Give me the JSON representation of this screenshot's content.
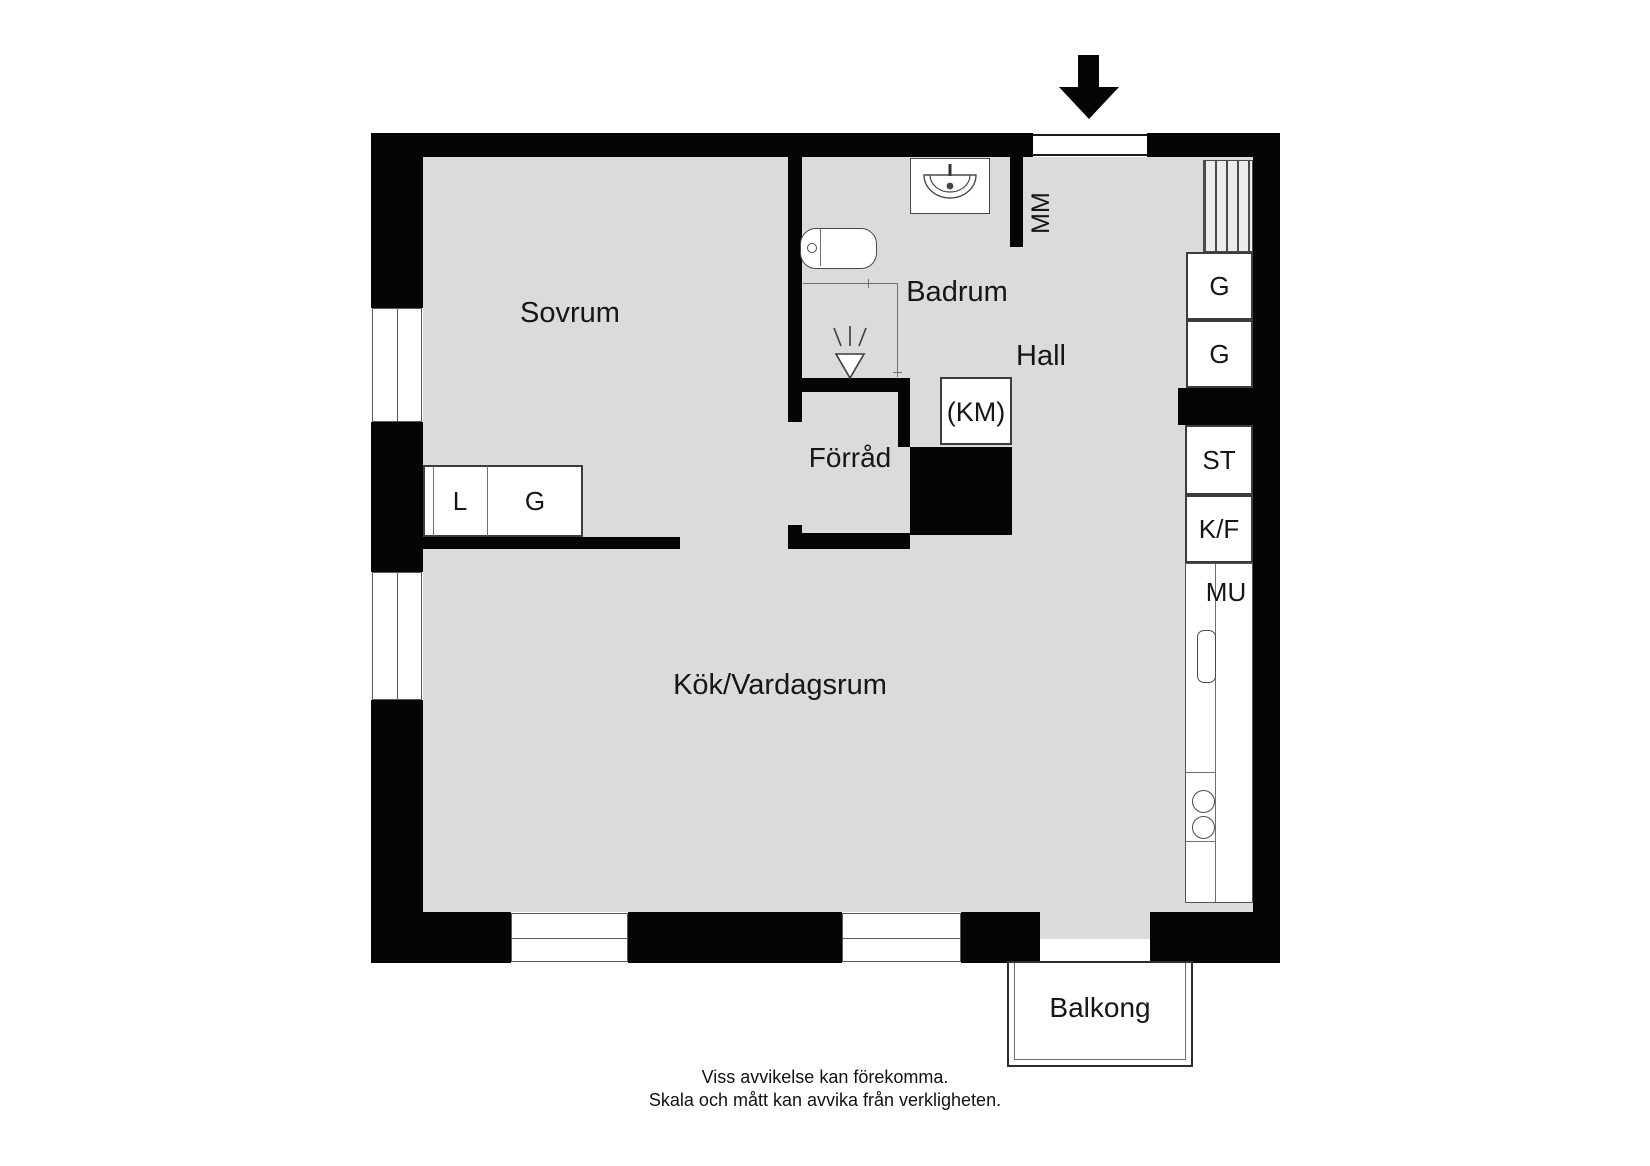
{
  "floorplan": {
    "title": "apartment-floor-plan",
    "rooms": {
      "sovrum": {
        "label": "Sovrum"
      },
      "badrum": {
        "label": "Badrum"
      },
      "hall": {
        "label": "Hall"
      },
      "forrad": {
        "label": "Förråd"
      },
      "kok_vardagsrum": {
        "label": "Kök/Vardagsrum"
      },
      "balkong": {
        "label": "Balkong"
      }
    },
    "fixtures": {
      "mm": {
        "label": "MM"
      },
      "km": {
        "label": "(KM)"
      },
      "bedroom_closet": {
        "left_label": "L",
        "right_label": "G"
      },
      "hall_wardrobe_upper": {
        "label": "G"
      },
      "hall_wardrobe_lower": {
        "label": "G"
      },
      "cleaning_cabinet": {
        "label": "ST"
      },
      "fridge_freezer": {
        "label": "K/F"
      },
      "microwave": {
        "label": "MU"
      }
    },
    "icons": [
      "entry-arrow-icon",
      "toilet-icon",
      "bath-sink-icon",
      "shower-icon",
      "stove-burners-icon",
      "kitchen-sink-icon",
      "radiator-hatch-icon"
    ],
    "colors": {
      "wall": "#050505",
      "floor": "#dbdbdb",
      "fixture_outline": "#3c3c3c",
      "background": "#ffffff"
    },
    "footer": {
      "line1": "Viss avvikelse kan förekomma.",
      "line2": "Skala och mått kan avvika från verkligheten."
    }
  }
}
